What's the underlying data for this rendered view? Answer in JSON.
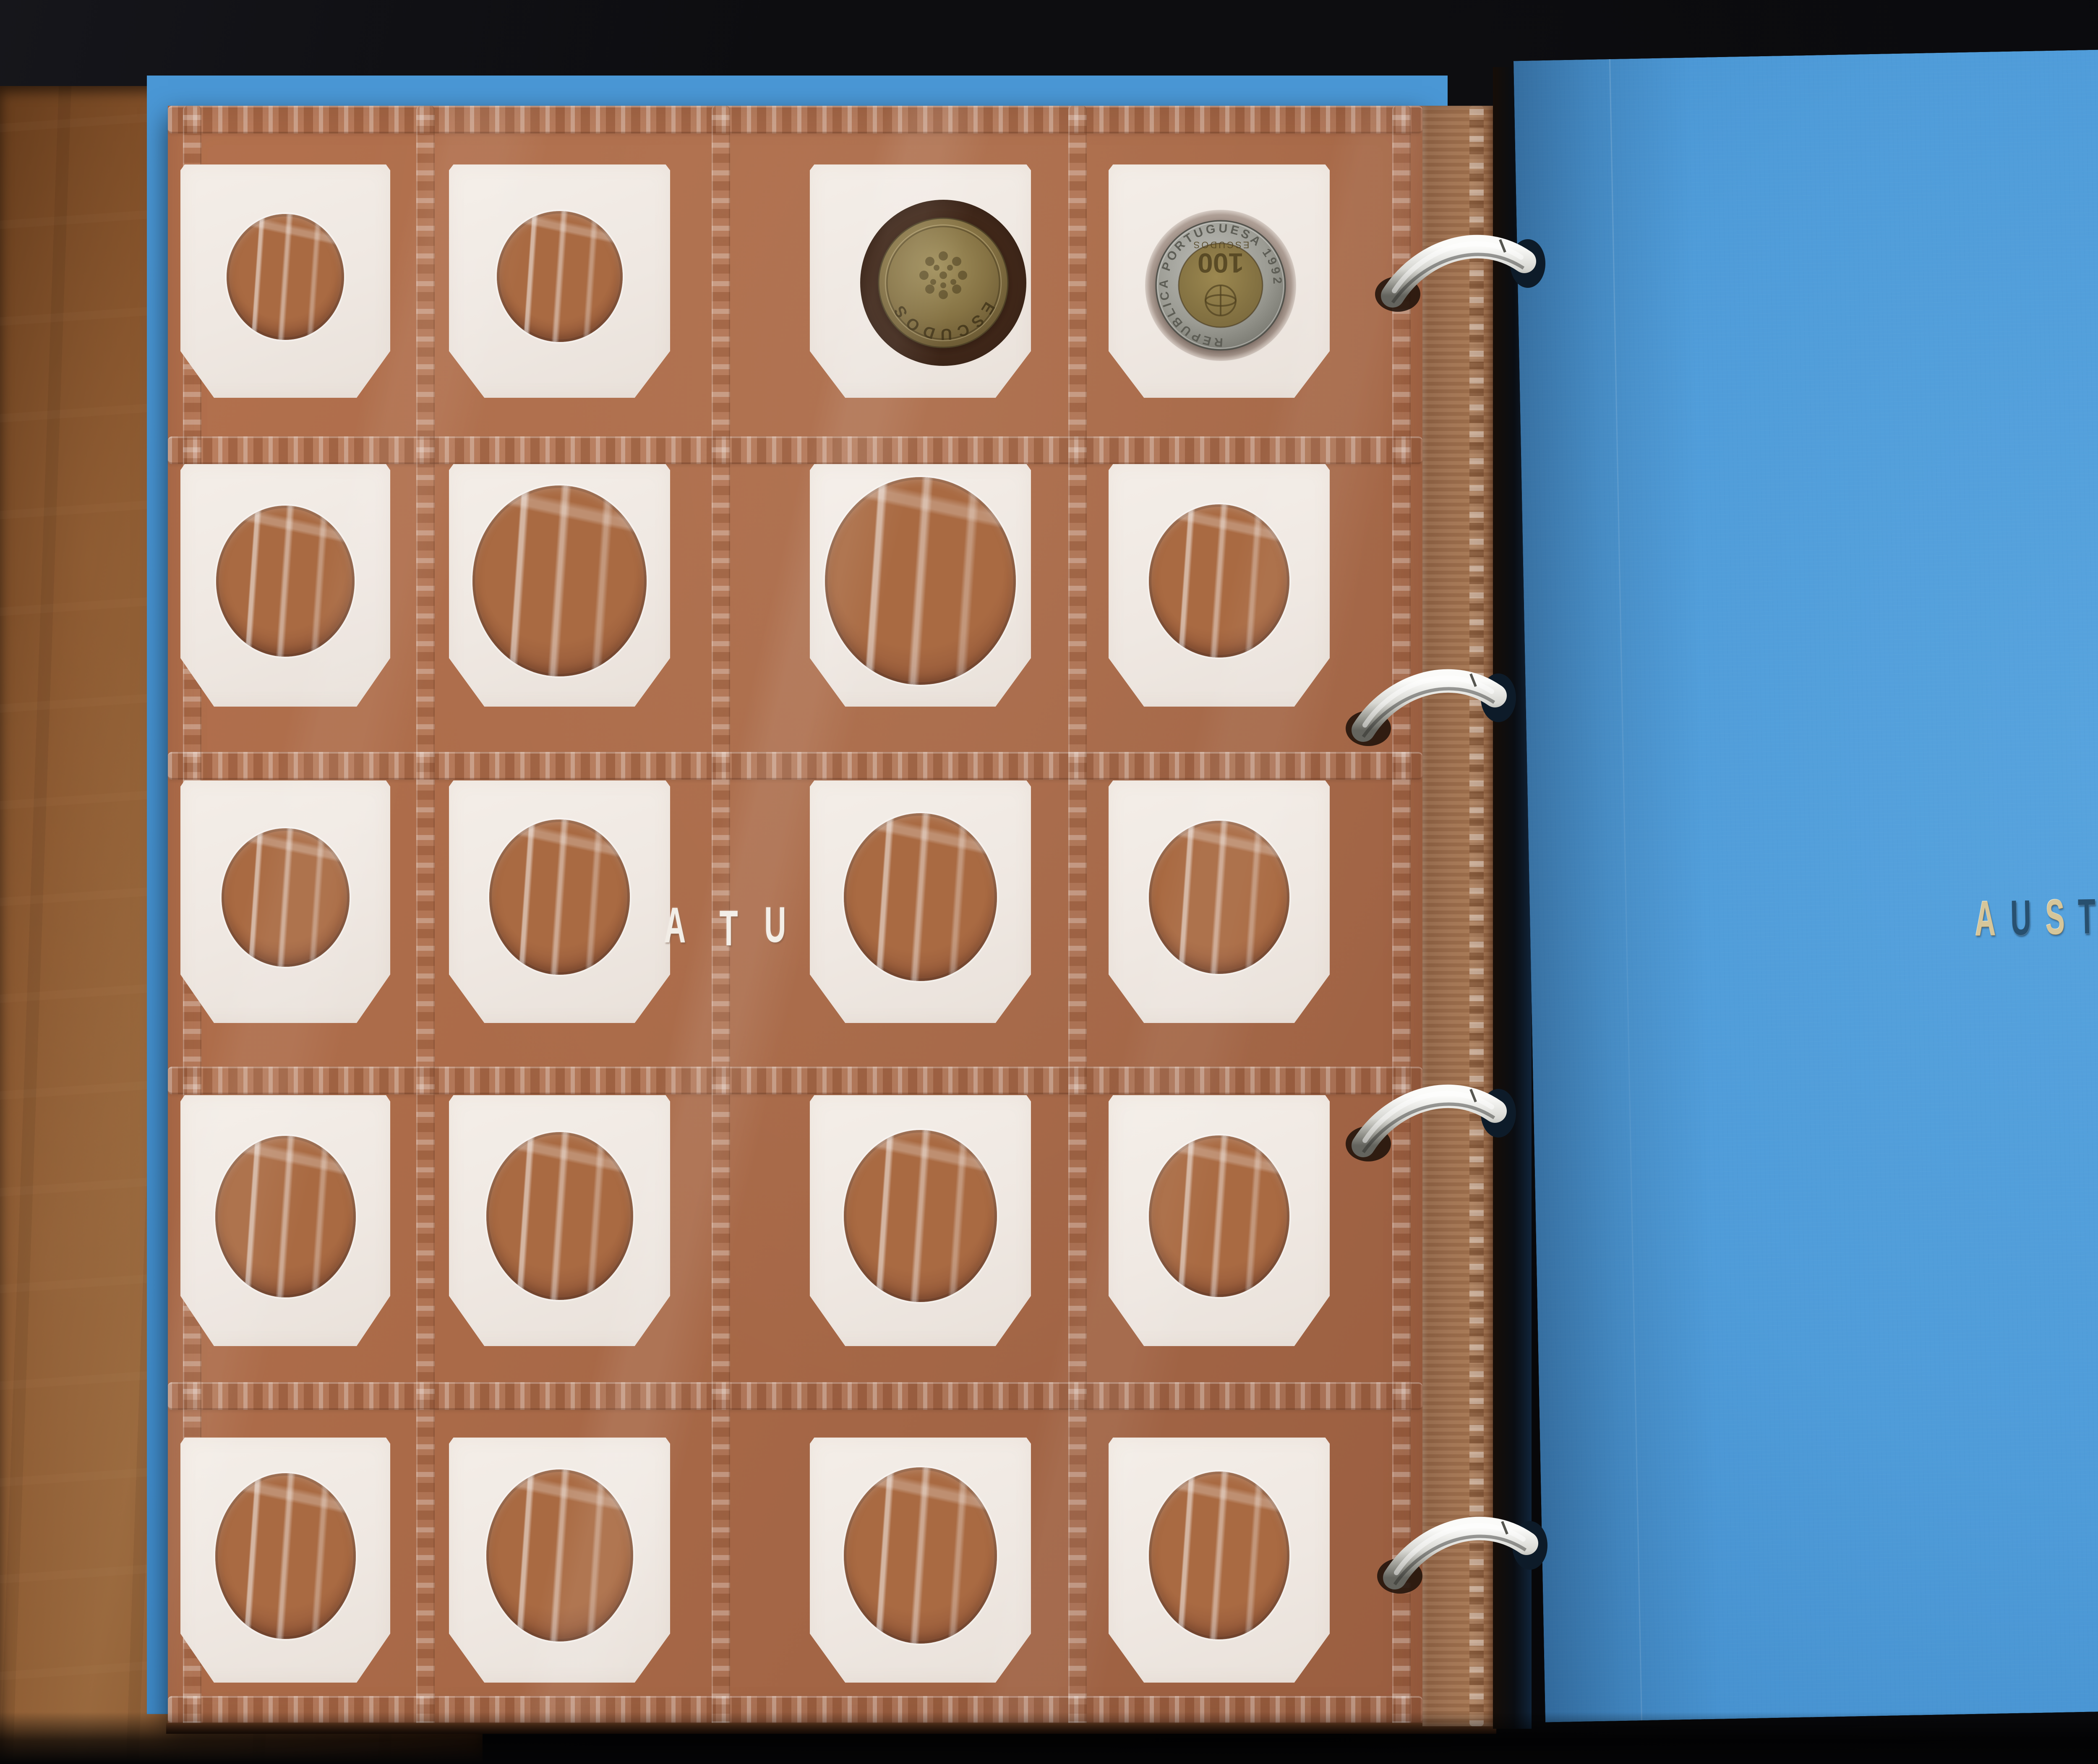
{
  "photo": {
    "alt": "Open coin collector album: left brown page of mostly empty white cardboard coin flips with two Portuguese escudo coins, silver binder rings, and a blue divider page titled AUSTRIA"
  },
  "left_page": {
    "rows": 5,
    "columns": 4,
    "empty_slot_count": 18,
    "occupied_slots": [
      {
        "row": 1,
        "col": 3,
        "coin": "brass"
      },
      {
        "row": 1,
        "col": 4,
        "coin": "bimetallic"
      }
    ],
    "partial_letters": [
      "A",
      "T",
      "U"
    ]
  },
  "coins": {
    "brass": {
      "legend": "ESCUDOS"
    },
    "bimetallic": {
      "outer_legend": "REPUBLICA PORTUGUESA 1992",
      "value": "100",
      "inner_legend": "ESCUDOS"
    }
  },
  "right_page": {
    "title": "AUSTRIA",
    "letters": [
      {
        "ch": "A",
        "tone": "gold"
      },
      {
        "ch": "U",
        "tone": "dark"
      },
      {
        "ch": "S",
        "tone": "gold"
      },
      {
        "ch": "T",
        "tone": "dark"
      },
      {
        "ch": "R",
        "tone": "gold"
      },
      {
        "ch": "I",
        "tone": "gold"
      },
      {
        "ch": "A",
        "tone": "dark"
      }
    ]
  },
  "binder": {
    "ring_count": 4
  },
  "colors": {
    "background": "#08080a",
    "leather_brown": "#8a5a33",
    "left_page_brown": "#ab6c4b",
    "holder_white": "#f0e9e3",
    "window_brown": "#9c5f3e",
    "right_page_blue": "#4f9cd9",
    "ring_silver": "#c9c9c4",
    "title_gold": "#d6c69a",
    "title_dark": "#28506f"
  }
}
